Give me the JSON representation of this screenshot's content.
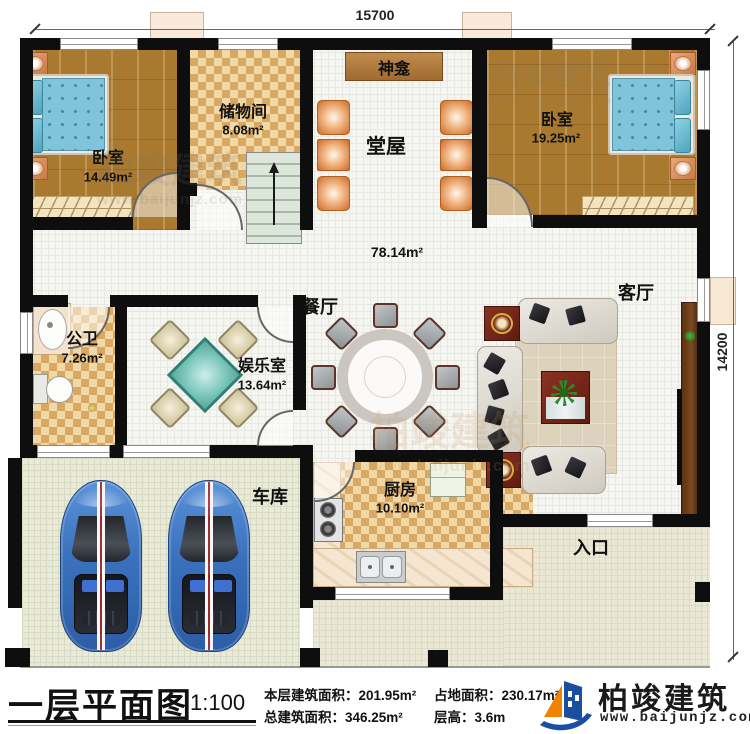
{
  "plan": {
    "dim_top": "15700",
    "dim_right": "14200",
    "rooms": {
      "bedroom1": {
        "label": "卧室",
        "area": "14.49m²"
      },
      "storage": {
        "label": "储物间",
        "area": "8.08m²"
      },
      "shrine": {
        "label": "神龛"
      },
      "hall": {
        "label": "堂屋"
      },
      "bedroom2": {
        "label": "卧室",
        "area": "19.25m²"
      },
      "central": {
        "area": "78.14m²"
      },
      "bathroom": {
        "label": "公卫",
        "area": "7.26m²"
      },
      "gameroom": {
        "label": "娱乐室",
        "area": "13.64m²"
      },
      "dining": {
        "label": "餐厅"
      },
      "living": {
        "label": "客厅"
      },
      "kitchen": {
        "label": "厨房",
        "area": "10.10m²"
      },
      "garage": {
        "label": "车库"
      },
      "entrance": {
        "label": "入口"
      }
    }
  },
  "title_block": {
    "title": "一层平面图",
    "scale": "1:100",
    "stats": [
      {
        "label": "本层建筑面积：",
        "value": "201.95m²"
      },
      {
        "label": "占地面积：",
        "value": "230.17m²"
      },
      {
        "label": "总建筑面积：",
        "value": "346.25m²"
      },
      {
        "label": "层高：",
        "value": "3.6m"
      }
    ]
  },
  "brand": {
    "name": "柏竣建筑",
    "url": "www.baijunjz.com"
  },
  "watermark": {
    "text": "柏竣建筑",
    "url": "www.baijunjz.com"
  },
  "colors": {
    "wall": "#0e0e0e",
    "wood": "#a9792f",
    "checker": "#d9a75f",
    "logo_blue": "#1a4fa0",
    "logo_orange": "#f08300"
  }
}
